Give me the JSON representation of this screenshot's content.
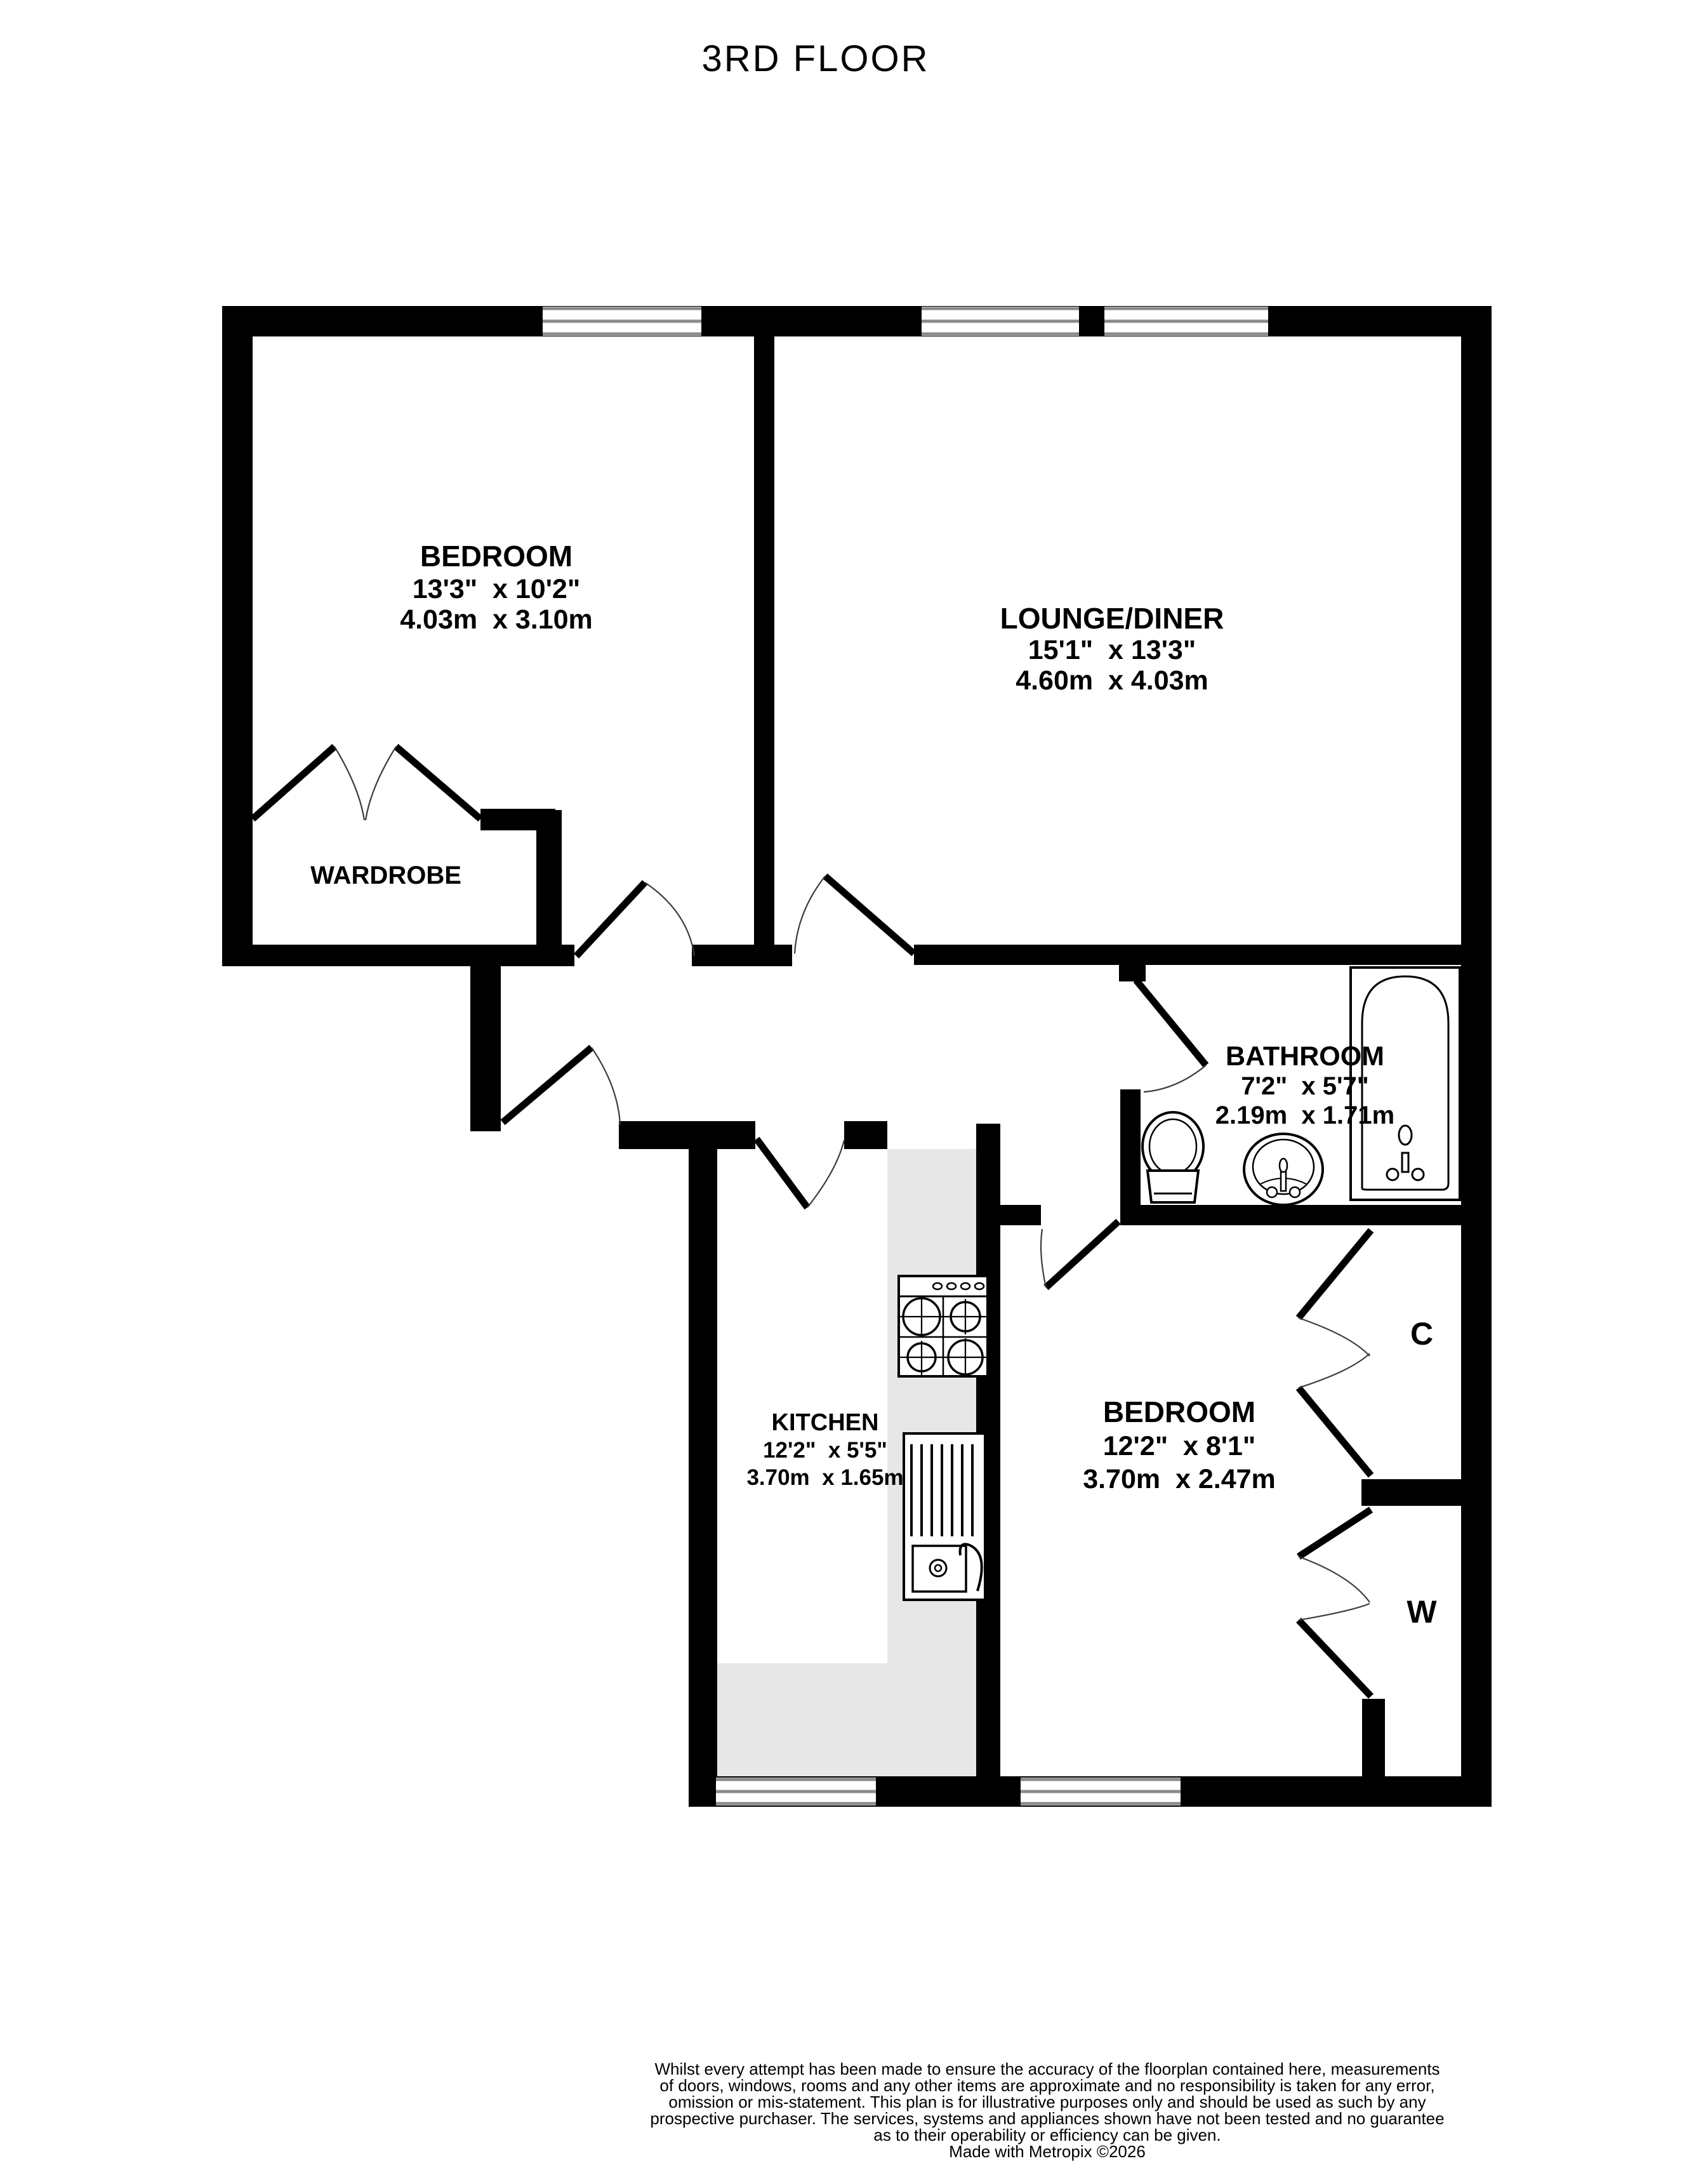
{
  "title": "3RD FLOOR",
  "floorplan": {
    "rooms": {
      "bedroom1": {
        "name": "BEDROOM",
        "imperial": "13'3\"  x 10'2\"",
        "metric": "4.03m  x 3.10m"
      },
      "lounge": {
        "name": "LOUNGE/DINER",
        "imperial": "15'1\"  x 13'3\"",
        "metric": "4.60m  x 4.03m"
      },
      "bathroom": {
        "name": "BATHROOM",
        "imperial": "7'2\"  x 5'7\"",
        "metric": "2.19m  x 1.71m"
      },
      "kitchen": {
        "name": "KITCHEN",
        "imperial": "12'2\"  x 5'5\"",
        "metric": "3.70m  x 1.65m"
      },
      "bedroom2": {
        "name": "BEDROOM",
        "imperial": "12'2\"  x 8'1\"",
        "metric": "3.70m  x 2.47m"
      },
      "wardrobe": {
        "name": "WARDROBE"
      },
      "closet_c": {
        "name": "C"
      },
      "closet_w": {
        "name": "W"
      }
    },
    "colors": {
      "wall": "#000000",
      "window_line": "#8b8b8b",
      "kitchen_floor": "#e7e7e7",
      "background": "#ffffff"
    }
  },
  "footer": {
    "lines": [
      "Whilst every attempt has been made to ensure the accuracy of the floorplan contained here, measurements",
      "of doors, windows, rooms and any other items are approximate and no responsibility is taken for any error,",
      "omission or mis-statement. This plan is for illustrative purposes only and should be used as such by any",
      "prospective purchaser. The services, systems and appliances shown have not been tested and no guarantee",
      "as to their operability or efficiency can be given.",
      "Made with Metropix ©2026"
    ]
  }
}
